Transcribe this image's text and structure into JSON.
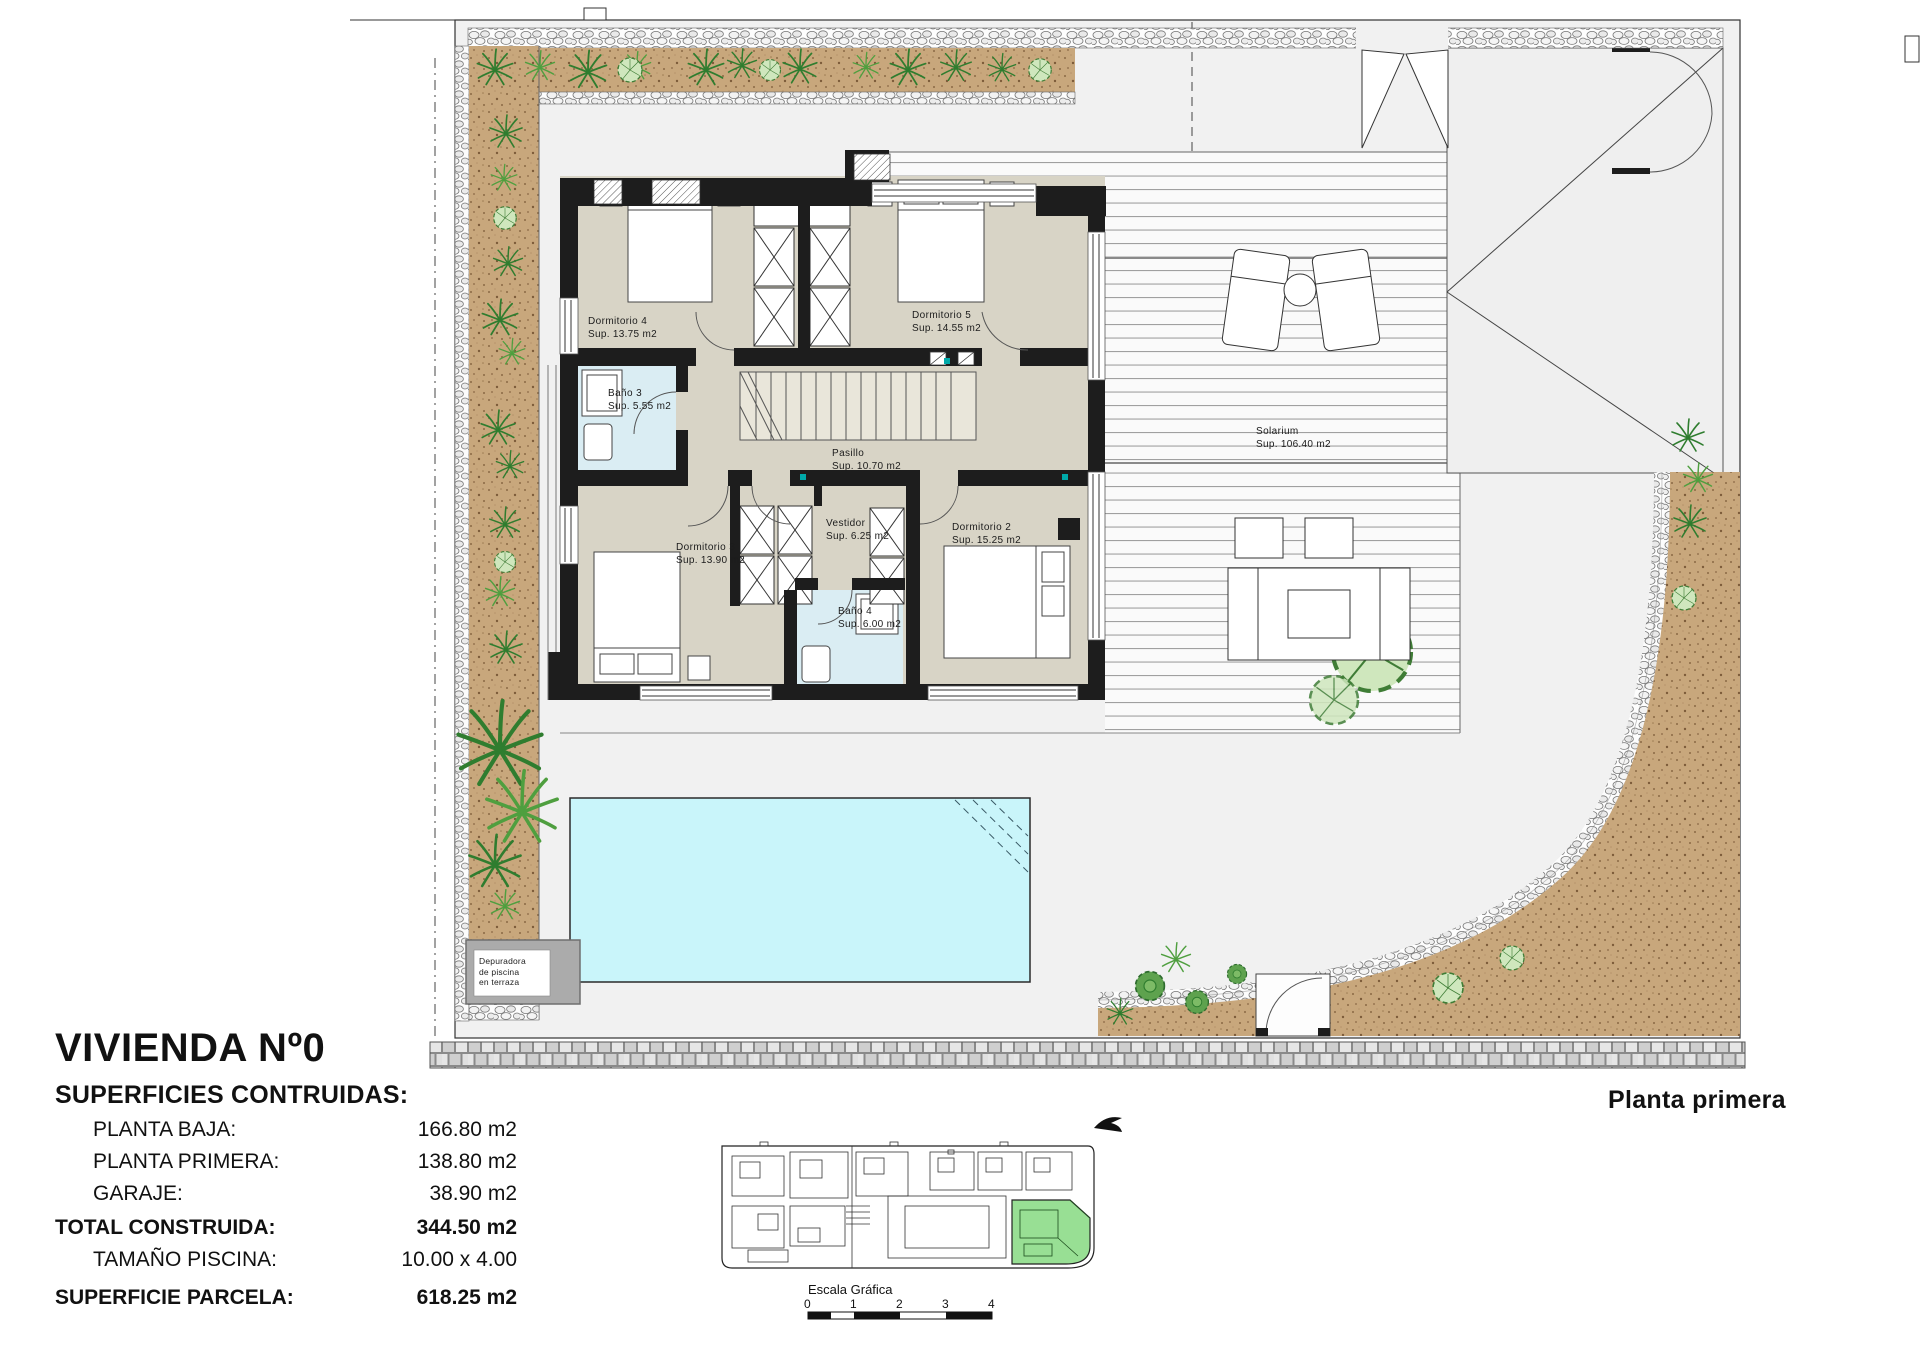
{
  "header": {
    "floor_label": "Planta primera"
  },
  "title_block": {
    "title": "VIVIENDA Nº0",
    "subtitle": "SUPERFICIES CONTRUIDAS:",
    "rows": [
      {
        "label": "PLANTA BAJA:",
        "value": "166.80 m2"
      },
      {
        "label": "PLANTA PRIMERA:",
        "value": "138.80 m2"
      },
      {
        "label": "GARAJE:",
        "value": "38.90 m2"
      },
      {
        "label": "TOTAL CONSTRUIDA:",
        "value": "344.50 m2"
      },
      {
        "label": "TAMAÑO PISCINA:",
        "value": "10.00 x 4.00"
      },
      {
        "label": "SUPERFICIE PARCELA:",
        "value": "618.25 m2"
      }
    ]
  },
  "rooms": [
    {
      "name": "Dormitorio 4",
      "area": "Sup. 13.75 m2"
    },
    {
      "name": "Dormitorio 5",
      "area": "Sup. 14.55 m2"
    },
    {
      "name": "Baño 3",
      "area": "Sup. 5.55 m2"
    },
    {
      "name": "Pasillo",
      "area": "Sup. 10.70 m2"
    },
    {
      "name": "Solarium",
      "area": "Sup. 106.40 m2"
    },
    {
      "name": "Dormitorio 3",
      "area": "Sup. 13.90 m2"
    },
    {
      "name": "Vestidor",
      "area": "Sup. 6.25 m2"
    },
    {
      "name": "Dormitorio 2",
      "area": "Sup. 15.25 m2"
    },
    {
      "name": "Baño 4",
      "area": "Sup. 6.00 m2"
    }
  ],
  "annotations": {
    "depuradora_lines": [
      "Depuradora",
      "de piscina",
      "en terraza"
    ]
  },
  "scale_bar": {
    "label": "Escala Gráfica",
    "ticks": [
      "0",
      "1",
      "2",
      "3",
      "4"
    ]
  },
  "colors": {
    "room_fill": "#d8d4c6",
    "bath_fill": "#daedf3",
    "pool_fill": "#c9f5fa",
    "soil_fill": "#c8a77c",
    "plant_green": "#3f8f3f",
    "highlight_unit": "#98df94",
    "wall": "#1d1d1d"
  }
}
